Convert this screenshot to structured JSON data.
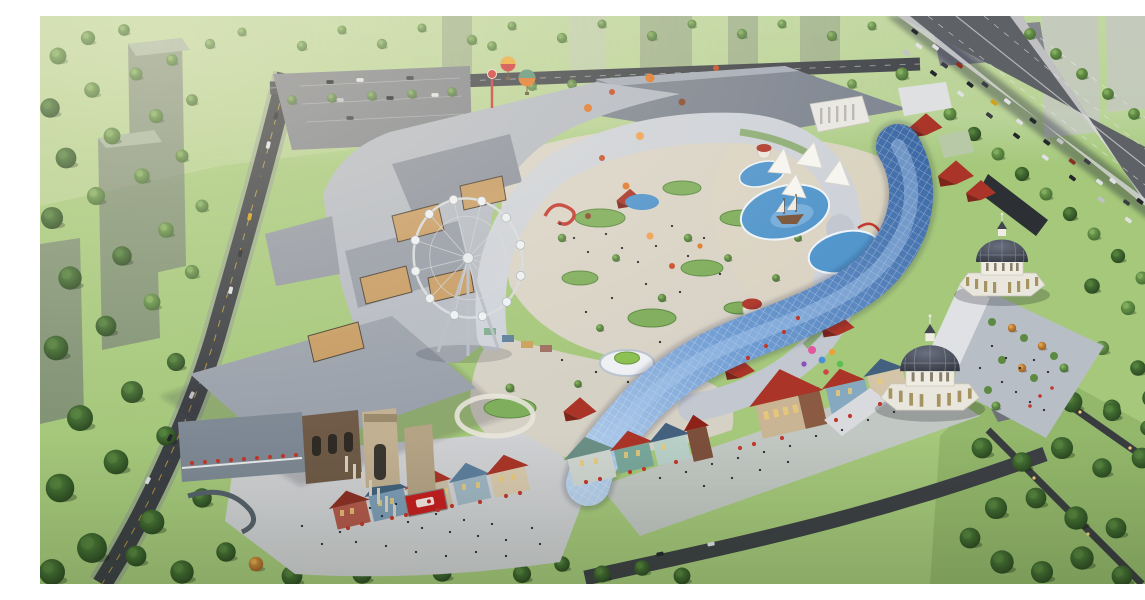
{
  "scene": {
    "description": "Aerial architectural rendering of a large open-air retail and entertainment complex with a ferris wheel, serpentine glass canopy, twin domed pavilions, colorful European-style shopping street, water play park, entry plazas, surrounding tree-lined streets, an elevated highway with traffic and semi-transparent residential towers",
    "view": "aerial oblique",
    "style": "photorealistic render",
    "time_of_day": "late afternoon"
  },
  "canvas": {
    "width": 1145,
    "height": 568
  },
  "palette": {
    "lawn": "#a5c87b",
    "lawn_haze": "#c3d8a5",
    "tree_mid": "#55833f",
    "tree_dark": "#33522b",
    "tree_autumn": "#cf8f3a",
    "roof_gray": "#99a0ab",
    "roof_gray_light": "#b5bac3",
    "roof_dark": "#7e8591",
    "roof_cream": "#ced2d9",
    "glass_blue_light": "#a9c8ec",
    "glass_blue_dark": "#3e6aa6",
    "red_roof": "#a93427",
    "blue_roof": "#43617e",
    "dome_dark": "#42474f",
    "dome_base": "#e9e6de",
    "water": "#5296cc",
    "road": "#3c3f44",
    "highway": "#5e6166",
    "paving_warm": "#d9d3c7",
    "paving_cool": "#cfd0d3",
    "stone_beige": "#c2b092",
    "stone_brown": "#6e5a46",
    "billboard_red": "#c41e1e",
    "umbrella_red": "#c2372c",
    "balloon_orange": "#e07a2e",
    "balloon_pink": "#e2579e",
    "balloon_blue": "#4a8fd7",
    "ghost_tower": "#63676f",
    "white_edge": "#ffffff"
  },
  "objects": [
    {
      "id": "ferris-wheel",
      "label": "Ferris wheel"
    },
    {
      "id": "glass-canopy",
      "label": "Serpentine glass canopy"
    },
    {
      "id": "dome-pavilion-north",
      "label": "Domed pavilion (north)"
    },
    {
      "id": "dome-pavilion-south",
      "label": "Domed pavilion (south)"
    },
    {
      "id": "shopping-street",
      "label": "Colorful shopping street"
    },
    {
      "id": "water-park",
      "label": "Water play park with sail tents and ship"
    },
    {
      "id": "entry-plaza",
      "label": "Stone entry gate plaza"
    },
    {
      "id": "elevated-highway",
      "label": "Elevated highway with traffic"
    },
    {
      "id": "residential-towers",
      "label": "Semi-transparent residential towers"
    },
    {
      "id": "hot-air-balloons",
      "label": "Decorative balloons"
    }
  ]
}
